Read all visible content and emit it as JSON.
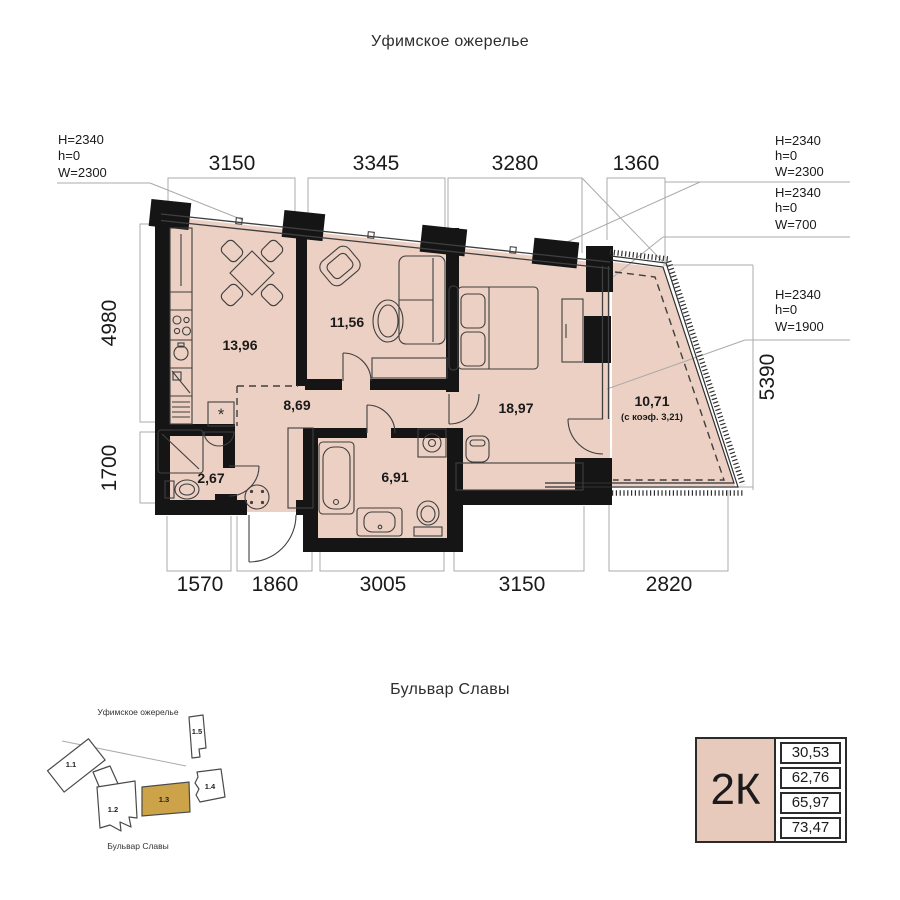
{
  "title": "Уфимское ожерелье",
  "street_label": "Бульвар Славы",
  "dims": {
    "top": [
      "3150",
      "3345",
      "3280",
      "1360"
    ],
    "bottom": [
      "1570",
      "1860",
      "3005",
      "3150",
      "2820"
    ],
    "left": [
      "4980",
      "1700"
    ],
    "right": [
      "5390"
    ]
  },
  "windows": [
    {
      "lines": [
        "H=2340",
        "h=0",
        "W=2300"
      ]
    },
    {
      "lines": [
        "H=2340",
        "h=0",
        "W=2300"
      ]
    },
    {
      "lines": [
        "H=2340",
        "h=0",
        "W=700"
      ]
    },
    {
      "lines": [
        "H=2340",
        "h=0",
        "W=1900"
      ]
    }
  ],
  "rooms": {
    "kitchen": "13,96",
    "living": "11,56",
    "hall": "8,69",
    "bedroom": "18,97",
    "bathroom": "2,67",
    "bath": "6,91",
    "balcony": "10,71",
    "balcony_note": "(с коэф. 3,21)"
  },
  "marks": {
    "asterisk": "*"
  },
  "site_plan": {
    "district_label": "Уфимское ожерелье",
    "street_label": "Бульвар Славы",
    "buildings": [
      {
        "label": "1.1",
        "highlighted": false
      },
      {
        "label": "1.2",
        "highlighted": false
      },
      {
        "label": "1.3",
        "highlighted": true
      },
      {
        "label": "1.4",
        "highlighted": false
      },
      {
        "label": "1.5",
        "highlighted": false
      }
    ]
  },
  "info_card": {
    "type": "2К",
    "areas": [
      "30,53",
      "62,76",
      "65,97",
      "73,47"
    ]
  },
  "colors": {
    "plan_fill": "#ECD0C3",
    "wall": "#151515",
    "highlight": "#CDA349",
    "dim_line": "#ABABAB",
    "card_fill": "#E8CABC"
  }
}
